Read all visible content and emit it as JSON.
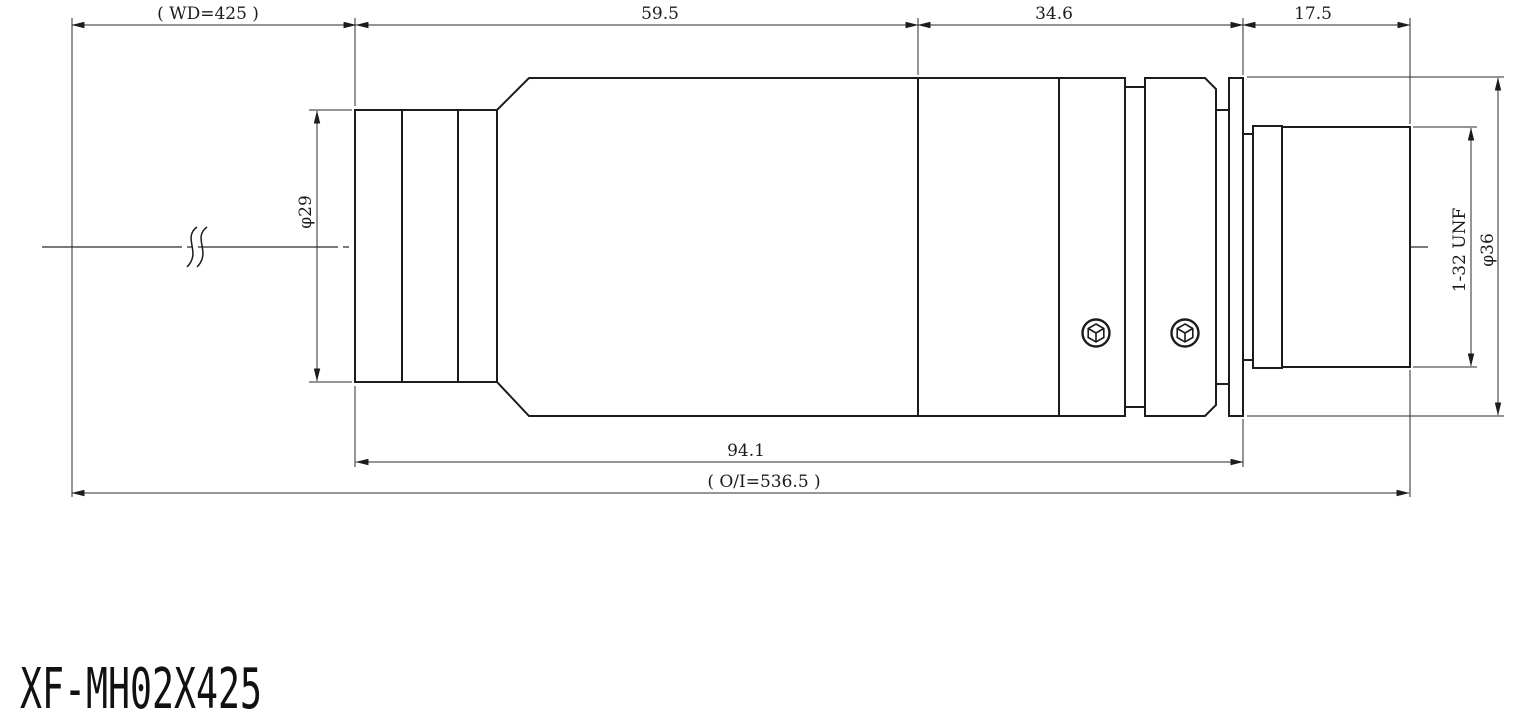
{
  "drawing": {
    "part_number": "XF-MH02X425",
    "dimensions": {
      "working_distance": "( WD=425 )",
      "front_section_length": "59.5",
      "mid_section_length": "34.6",
      "rear_section_length": "17.5",
      "barrel_length": "94.1",
      "object_to_image": "( O/I=536.5 )",
      "front_diameter": "φ29",
      "mount_thread": "1-32 UNF",
      "max_diameter": "φ36"
    },
    "colors": {
      "line": "#1c1c1c",
      "background": "#ffffff"
    }
  }
}
